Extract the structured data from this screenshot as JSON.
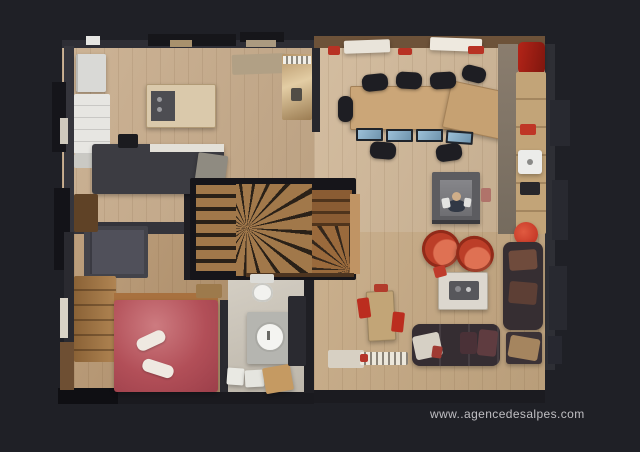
{
  "watermark": {
    "url_text": "www..agencedesalpes.com"
  },
  "scene": {
    "description": "3D dollhouse top-down scan of a chalet apartment floor plan on a dark background",
    "rooms": [
      "kitchen",
      "entry-hall",
      "office",
      "staircase",
      "bedroom",
      "bathroom",
      "living-room"
    ]
  },
  "colors": {
    "bg": "#1f2026",
    "floor-hall": "#c7ab8a",
    "floor-office": "#cfb696",
    "floor-living": "#c4a781",
    "floor-bedroom": "#b5946e",
    "floor-bath": "#ccc5b8",
    "wall": "#2e2e35",
    "wall-black": "#15151a",
    "wall-brown": "#6d5239",
    "counter-white": "#e7e6e2",
    "island-wood": "#dac9ab",
    "dark-unit": "#3c3c42",
    "desk-wood": "#cba678",
    "chair-black": "#1e1e23",
    "screen-blue": "#9cc0d8",
    "red-accent": "#b83224",
    "bed-red": "#b24f58",
    "tub-red": "#bc3e28",
    "sofa-dark": "#352d32",
    "table-white": "#dcd7ce",
    "sideboard-wood": "#c2a478",
    "stair-tread": "#a1784a",
    "stair-dark": "#2a2118",
    "rug-light": "#d7d0c3",
    "vanity-gray": "#b5b5b0",
    "porcelain": "#f2f2ef",
    "watermark": "#cdccd0"
  }
}
